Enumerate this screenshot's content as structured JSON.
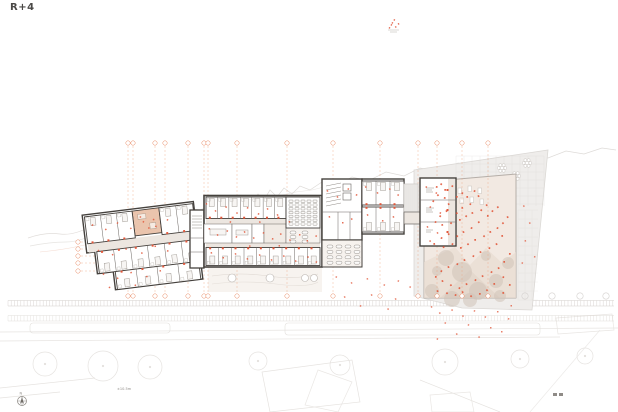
{
  "title": {
    "label": "R+4"
  },
  "annotations": {
    "level_mark": "±10.5m",
    "north_label": "N"
  },
  "colors": {
    "wall": "#45413d",
    "partition": "#6b6662",
    "furniture": "#a39d97",
    "corridor": "#ece6e0",
    "accent_orange": "#e2573a",
    "grid_orange": "#eda27f",
    "terrace": "#f2e9e2",
    "tree": "#cfc3b8",
    "site": "#efedeb",
    "context": "#e4e1de"
  },
  "plan": {
    "grid": {
      "vertical_x": [
        128,
        133,
        155,
        165,
        188,
        204,
        208,
        237,
        287,
        333,
        380,
        418,
        437,
        462,
        488
      ],
      "top_bubble_y": 143,
      "bottom_bubble_y": 296,
      "line_y1": 146,
      "line_y2": 293,
      "left_axis_y": [
        242,
        249,
        256,
        263,
        271
      ],
      "left_axis_bubble_x": 78,
      "gray_bubbles": [
        [
          525,
          296
        ],
        [
          552,
          296
        ],
        [
          580,
          296
        ],
        [
          606,
          296
        ]
      ]
    },
    "strips": [
      {
        "y": 300.5,
        "h": 5.5,
        "x1": 8,
        "x2": 614,
        "step": 3.2,
        "color": "#c6c0bb",
        "opacity": 0.75
      },
      {
        "y": 315.5,
        "h": 5.5,
        "x1": 8,
        "x2": 614,
        "step": 3.2,
        "color": "#d6d1cc",
        "opacity": 0.7
      }
    ],
    "room_bands": [
      {
        "parent": "g-bar-rooms",
        "x": 206,
        "y": 197,
        "w": 80,
        "h": 21.5,
        "count": 7,
        "door": "bottom"
      },
      {
        "parent": "g-bar-rooms",
        "x": 206,
        "y": 247.5,
        "w": 114,
        "h": 18,
        "count": 9,
        "door": "top"
      },
      {
        "parent": "g-midright-rooms",
        "x": 362,
        "y": 181,
        "w": 42,
        "h": 24,
        "count": 3,
        "door": "bottom"
      },
      {
        "parent": "g-midright-rooms",
        "x": 362,
        "y": 207,
        "w": 42,
        "h": 25,
        "count": 3,
        "door": "top"
      },
      {
        "parent": "g-left-rooms",
        "x": 88,
        "y": 204,
        "w": 48,
        "h": 27,
        "count": 3,
        "door": "bottom"
      },
      {
        "parent": "g-left-rooms",
        "x": 163,
        "y": 204,
        "w": 34,
        "h": 27,
        "count": 2,
        "door": "bottom"
      },
      {
        "parent": "g-left-rooms",
        "x": 96,
        "y": 240,
        "w": 102,
        "h": 22,
        "count": 6,
        "door": "top"
      },
      {
        "parent": "g-left-rooms",
        "x": 112,
        "y": 262,
        "w": 84,
        "h": 18,
        "count": 4,
        "door": "top"
      }
    ],
    "seat_grids": [
      {
        "parent": "g-auditorium",
        "x": 289,
        "y": 200,
        "cols": 5,
        "rows": 7,
        "dx": 6,
        "dy": 3.8,
        "w": 4,
        "h": 2.4,
        "rx": 0.4
      },
      {
        "parent": "g-lounge",
        "x": 327,
        "y": 245,
        "cols": 4,
        "rows": 4,
        "dx": 9,
        "dy": 5.4,
        "w": 6,
        "h": 3,
        "rx": 1.5
      },
      {
        "parent": "g-lounge2",
        "x": 290,
        "y": 231,
        "cols": 2,
        "rows": 3,
        "dx": 12,
        "dy": 4.5,
        "w": 6,
        "h": 3,
        "rx": 1.5
      }
    ],
    "terrace_trees": [
      [
        446,
        258,
        8
      ],
      [
        462,
        272,
        10
      ],
      [
        478,
        291,
        9
      ],
      [
        496,
        281,
        7
      ],
      [
        508,
        263,
        6
      ],
      [
        486,
        256,
        5
      ],
      [
        432,
        291,
        7
      ],
      [
        452,
        299,
        8
      ],
      [
        470,
        300,
        7
      ],
      [
        500,
        296,
        6
      ],
      [
        437,
        271,
        5
      ]
    ],
    "context_trees": [
      [
        45,
        364,
        12
      ],
      [
        103,
        366,
        15
      ],
      [
        150,
        367,
        12
      ],
      [
        258,
        361,
        9
      ],
      [
        340,
        365,
        10
      ],
      [
        445,
        362,
        13
      ],
      [
        520,
        359,
        9
      ],
      [
        585,
        356,
        8
      ]
    ],
    "flower_tables": [
      [
        502,
        168
      ],
      [
        516,
        176
      ],
      [
        507,
        187
      ],
      [
        527,
        163
      ]
    ],
    "garden_circles": [
      [
        232,
        278,
        4
      ],
      [
        270,
        278,
        4
      ],
      [
        305,
        278,
        3.5
      ],
      [
        314,
        278,
        3.5
      ]
    ],
    "speck_groups": [
      {
        "parent": "svg",
        "color": "#e2573a",
        "size": 1.7,
        "opacity": 0.9,
        "points": [
          [
            436,
            186
          ],
          [
            441,
            183
          ],
          [
            446,
            189
          ],
          [
            452,
            185
          ],
          [
            438,
            194
          ],
          [
            444,
            197
          ],
          [
            433,
            200
          ],
          [
            449,
            203
          ],
          [
            456,
            196
          ],
          [
            462,
            192
          ],
          [
            468,
            196
          ],
          [
            474,
            190
          ],
          [
            479,
            195
          ],
          [
            470,
            203
          ],
          [
            463,
            207
          ],
          [
            457,
            212
          ],
          [
            447,
            210
          ],
          [
            440,
            215
          ],
          [
            435,
            221
          ],
          [
            443,
            224
          ],
          [
            451,
            222
          ],
          [
            459,
            219
          ],
          [
            466,
            215
          ],
          [
            473,
            212
          ],
          [
            481,
            209
          ],
          [
            487,
            204
          ],
          [
            492,
            210
          ],
          [
            498,
            206
          ],
          [
            487,
            215
          ],
          [
            479,
            221
          ],
          [
            471,
            227
          ],
          [
            464,
            231
          ],
          [
            457,
            235
          ],
          [
            449,
            233
          ],
          [
            441,
            237
          ],
          [
            435,
            243
          ],
          [
            444,
            246
          ],
          [
            452,
            243
          ],
          [
            460,
            247
          ],
          [
            468,
            243
          ],
          [
            476,
            239
          ],
          [
            484,
            235
          ],
          [
            491,
            231
          ],
          [
            497,
            227
          ],
          [
            503,
            222
          ],
          [
            508,
            216
          ],
          [
            503,
            235
          ],
          [
            497,
            243
          ],
          [
            489,
            247
          ],
          [
            481,
            251
          ],
          [
            473,
            255
          ],
          [
            465,
            259
          ],
          [
            457,
            263
          ],
          [
            449,
            266
          ],
          [
            441,
            270
          ],
          [
            435,
            276
          ],
          [
            443,
            280
          ],
          [
            451,
            284
          ],
          [
            459,
            287
          ],
          [
            467,
            283
          ],
          [
            475,
            279
          ],
          [
            483,
            275
          ],
          [
            491,
            271
          ],
          [
            499,
            267
          ],
          [
            505,
            261
          ],
          [
            509,
            253
          ],
          [
            503,
            276
          ],
          [
            495,
            283
          ],
          [
            487,
            289
          ],
          [
            479,
            293
          ],
          [
            471,
            295
          ],
          [
            463,
            291
          ],
          [
            455,
            294
          ],
          [
            447,
            292
          ],
          [
            438,
            290
          ],
          [
            504,
            292
          ],
          [
            509,
            284
          ]
        ]
      },
      {
        "parent": "svg",
        "color": "#e2573a",
        "size": 1.5,
        "opacity": 0.75,
        "points": [
          [
            432,
            306
          ],
          [
            440,
            312
          ],
          [
            452,
            309
          ],
          [
            463,
            315
          ],
          [
            474,
            310
          ],
          [
            485,
            316
          ],
          [
            497,
            311
          ],
          [
            508,
            318
          ],
          [
            445,
            322
          ],
          [
            468,
            324
          ],
          [
            490,
            327
          ],
          [
            457,
            333
          ],
          [
            479,
            336
          ],
          [
            501,
            331
          ],
          [
            437,
            338
          ],
          [
            512,
            305
          ],
          [
            524,
            205
          ],
          [
            530,
            222
          ],
          [
            526,
            240
          ],
          [
            534,
            256
          ],
          [
            522,
            262
          ],
          [
            336,
            276
          ],
          [
            352,
            282
          ],
          [
            368,
            278
          ],
          [
            384,
            284
          ],
          [
            398,
            280
          ],
          [
            410,
            286
          ],
          [
            345,
            296
          ],
          [
            372,
            294
          ],
          [
            396,
            298
          ],
          [
            360,
            305
          ],
          [
            388,
            308
          ]
        ]
      },
      {
        "parent": "svg",
        "color": "#e2573a",
        "size": 1.5,
        "opacity": 0.85,
        "points": [
          [
            207,
            203
          ],
          [
            216,
            210
          ],
          [
            226,
            206
          ],
          [
            237,
            212
          ],
          [
            247,
            207
          ],
          [
            258,
            213
          ],
          [
            268,
            208
          ],
          [
            278,
            214
          ],
          [
            210,
            228
          ],
          [
            218,
            234
          ],
          [
            227,
            230
          ],
          [
            236,
            236
          ],
          [
            245,
            231
          ],
          [
            254,
            237
          ],
          [
            263,
            232
          ],
          [
            272,
            238
          ],
          [
            281,
            233
          ],
          [
            290,
            239
          ],
          [
            299,
            234
          ],
          [
            308,
            240
          ],
          [
            316,
            235
          ],
          [
            212,
            252
          ],
          [
            224,
            257
          ],
          [
            236,
            253
          ],
          [
            248,
            258
          ],
          [
            260,
            254
          ],
          [
            272,
            259
          ],
          [
            284,
            255
          ],
          [
            296,
            260
          ],
          [
            308,
            256
          ],
          [
            316,
            261
          ],
          [
            230,
            221
          ],
          [
            260,
            221
          ],
          [
            290,
            221
          ],
          [
            250,
            245
          ],
          [
            280,
            245
          ],
          [
            328,
            190
          ],
          [
            338,
            196
          ],
          [
            348,
            188
          ],
          [
            356,
            194
          ],
          [
            330,
            216
          ],
          [
            342,
            222
          ],
          [
            352,
            218
          ],
          [
            366,
            186
          ],
          [
            378,
            192
          ],
          [
            390,
            188
          ],
          [
            398,
            194
          ],
          [
            368,
            214
          ],
          [
            382,
            220
          ],
          [
            394,
            216
          ],
          [
            426,
            186
          ],
          [
            436,
            192
          ],
          [
            430,
            206
          ],
          [
            440,
            212
          ],
          [
            428,
            226
          ],
          [
            438,
            232
          ],
          [
            430,
            240
          ]
        ]
      },
      {
        "parent": "g-left-cluster",
        "color": "#e2573a",
        "size": 1.5,
        "opacity": 0.85,
        "points": [
          [
            95,
            212
          ],
          [
            108,
            218
          ],
          [
            120,
            213
          ],
          [
            133,
            220
          ],
          [
            146,
            215
          ],
          [
            158,
            221
          ],
          [
            170,
            216
          ],
          [
            98,
            238
          ],
          [
            112,
            244
          ],
          [
            126,
            240
          ],
          [
            140,
            246
          ],
          [
            154,
            241
          ],
          [
            166,
            247
          ],
          [
            100,
            262
          ],
          [
            114,
            268
          ],
          [
            128,
            264
          ],
          [
            142,
            270
          ],
          [
            156,
            266
          ],
          [
            104,
            276
          ],
          [
            130,
            277
          ],
          [
            143,
            210
          ],
          [
            150,
            222
          ],
          [
            156,
            214
          ]
        ]
      },
      {
        "parent": "svg",
        "color": "#e2573a",
        "size": 1.4,
        "opacity": 0.9,
        "points": [
          [
            392,
            22
          ],
          [
            396,
            26
          ],
          [
            389,
            27
          ],
          [
            394,
            19
          ],
          [
            399,
            23
          ],
          [
            391,
            24
          ]
        ]
      }
    ]
  }
}
